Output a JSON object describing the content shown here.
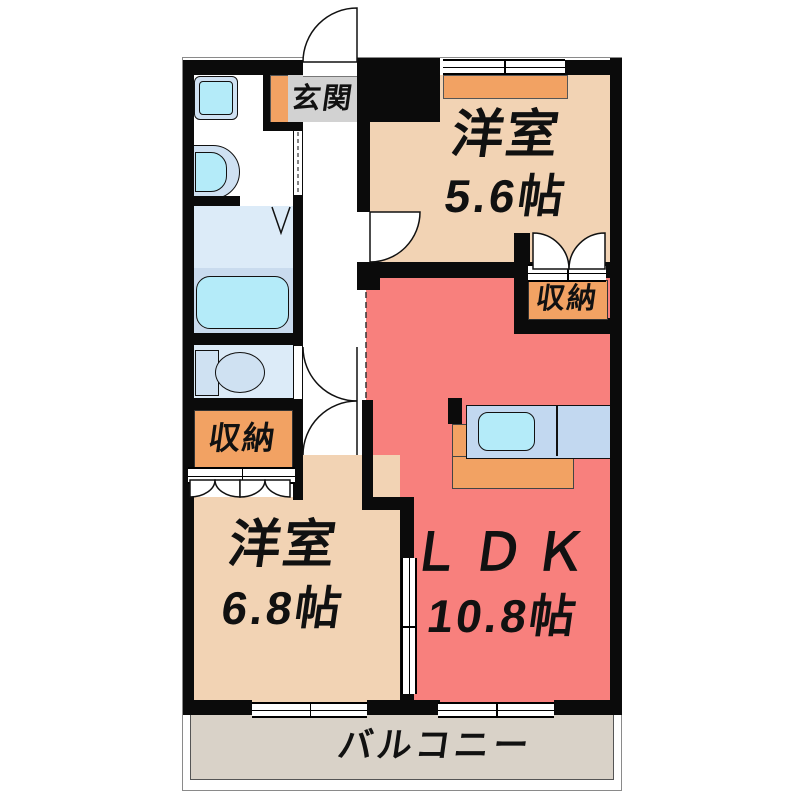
{
  "plan": {
    "type": "apartment-floor-plan",
    "rooms": {
      "entrance": {
        "label": "玄関"
      },
      "bedroom1": {
        "label": "洋室",
        "size": "5.6帖"
      },
      "bedroom2": {
        "label": "洋室",
        "size": "6.8帖"
      },
      "ldk": {
        "label": "ＬＤＫ",
        "size": "10.8帖"
      },
      "storage_bedroom1": {
        "label": "収納"
      },
      "storage_bedroom2": {
        "label": "収納"
      },
      "balcony": {
        "label": "バルコニー"
      }
    },
    "fixtures": [
      "washing-machine-pan-icon",
      "vanity-sink-icon",
      "bathtub-icon",
      "toilet-icon",
      "kitchen-counter-icon",
      "kitchen-sink-icon",
      "shoe-cabinet-icon",
      "closet-counter-icon"
    ],
    "colors": {
      "wall": "#0b0b0b",
      "bedroom": "#f2d3b4",
      "ldk": "#f8807d",
      "storage": "#f2a263",
      "bathroom": "#dcebf8",
      "bath-band": "#c9dbee",
      "water": "#b4ebf9",
      "fixture": "#cfe1f2",
      "balcony": "#d9d2c8",
      "entrance-bg": "#d2d2d2",
      "counter": "#c2d8f0"
    }
  }
}
